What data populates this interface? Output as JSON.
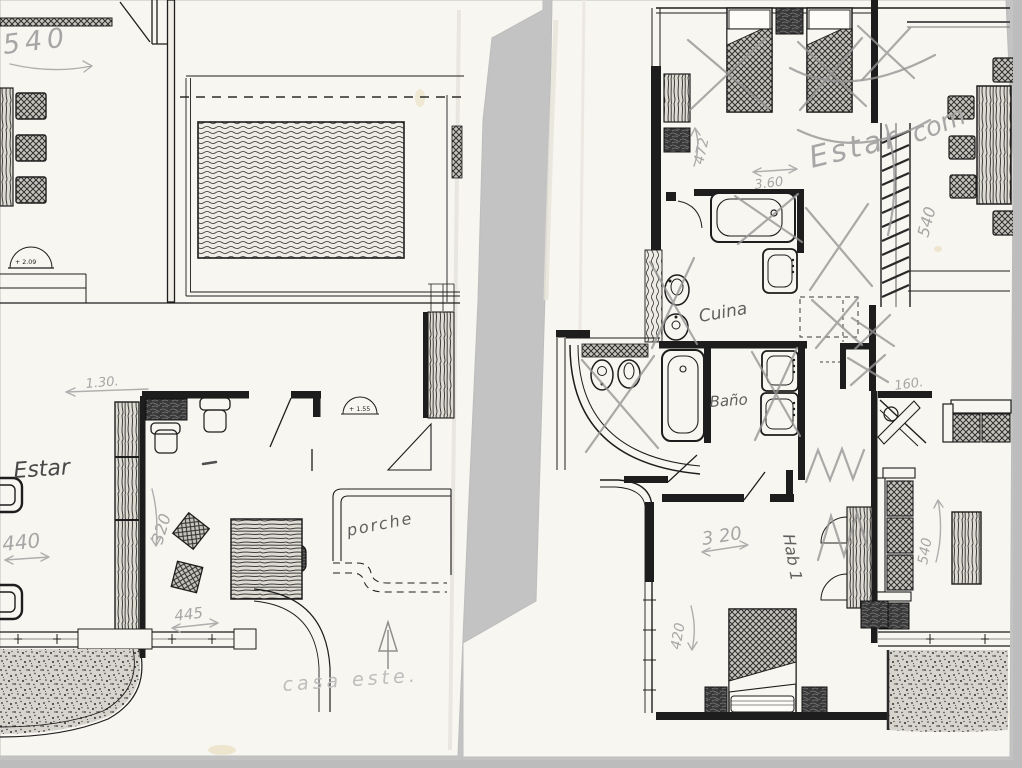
{
  "scan": {
    "scanner_background": "#c3c3c3",
    "sheet_color": "#f8f6f0",
    "ink_color": "#1d1d1d",
    "pencil_color": "#a6a6a6"
  },
  "left_plan": {
    "printed_labels": {
      "door_level_a": "+ 2.09",
      "door_level_b": "+ 1.55"
    },
    "annotations": {
      "dim_540": "540",
      "dim_130": "1.30.",
      "room_estar": "Estar",
      "dim_440": "440",
      "dim_320": "320",
      "dim_445": "445",
      "porch": "porche",
      "orientation": "casa  este."
    }
  },
  "right_plan": {
    "annotations": {
      "dim_472": "472",
      "dim_360": "3.60",
      "estar": "Estar",
      "com": "com",
      "dim_540_top": "540",
      "kitchen": "Cuina",
      "bath": "Baño",
      "dim_160": "160.",
      "dim_540_side": "540",
      "dim_320": "3 20",
      "room_hab1": "Hab 1",
      "dim_420": "420"
    }
  }
}
